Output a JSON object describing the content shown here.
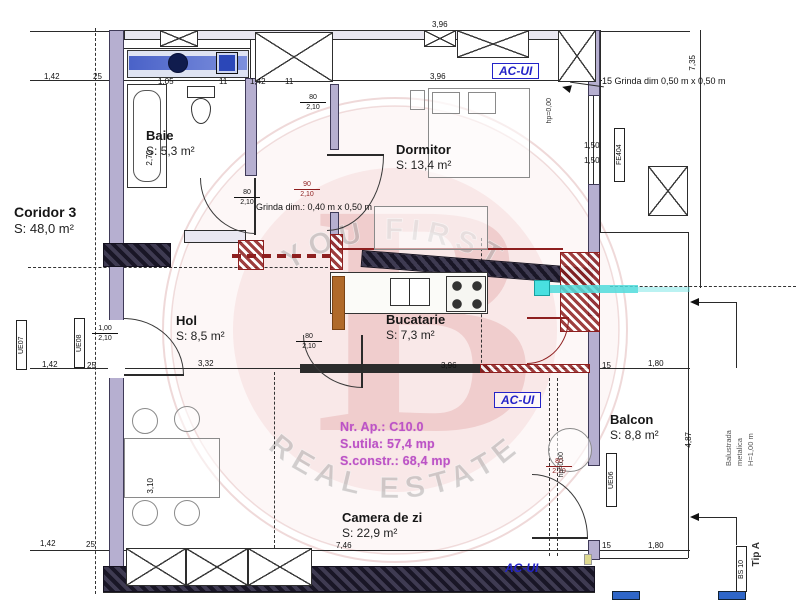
{
  "plan": {
    "rooms": [
      {
        "label": "Coridor 3",
        "area": "S: 48,0 m²",
        "x": 14,
        "y": 204,
        "fs": 14
      },
      {
        "label": "Baie",
        "area": "S: 5,3 m²",
        "x": 146,
        "y": 128,
        "fs": 13
      },
      {
        "label": "Dormitor",
        "area": "S: 13,4 m²",
        "x": 396,
        "y": 142,
        "fs": 13
      },
      {
        "label": "Hol",
        "area": "S: 8,5 m²",
        "x": 176,
        "y": 313,
        "fs": 13
      },
      {
        "label": "Bucatarie",
        "area": "S: 7,3 m²",
        "x": 386,
        "y": 312,
        "fs": 13
      },
      {
        "label": "Balcon",
        "area": "S: 8,8 m²",
        "x": 610,
        "y": 412,
        "fs": 13
      },
      {
        "label": "Camera de zi",
        "area": "S: 22,9 m²",
        "x": 342,
        "y": 510,
        "fs": 13
      }
    ],
    "apartment_info": {
      "line1": "Nr. Ap.: C10.0",
      "line2": "S.utila: 57,4 mp",
      "line3": "S.constr.: 68,4 mp"
    },
    "notes": [
      {
        "text": "15 Grinda dim 0,50 m x 0,50 m",
        "x": 602,
        "y": 76
      },
      {
        "text": "Grinda dim.: 0,40 m x 0,50 m",
        "x": 256,
        "y": 202
      }
    ],
    "ac_labels": [
      {
        "text": "AC-UI",
        "x": 492,
        "y": 63,
        "boxed": true
      },
      {
        "text": "AC-UI",
        "x": 494,
        "y": 392,
        "boxed": true
      },
      {
        "text": "AC-UI",
        "x": 505,
        "y": 561,
        "boxed": false
      }
    ],
    "dimensions": [
      {
        "t": "3,96",
        "x": 432,
        "y": 20
      },
      {
        "t": "1,42",
        "x": 44,
        "y": 72
      },
      {
        "t": "25",
        "x": 93,
        "y": 72
      },
      {
        "t": "1,05",
        "x": 158,
        "y": 77
      },
      {
        "t": "11",
        "x": 219,
        "y": 77
      },
      {
        "t": "1,42",
        "x": 250,
        "y": 77
      },
      {
        "t": "11",
        "x": 285,
        "y": 77
      },
      {
        "t": "3,96",
        "x": 430,
        "y": 72
      },
      {
        "t": "7,35",
        "x": 688,
        "y": 55,
        "v": true
      },
      {
        "t": "2,72",
        "x": 145,
        "y": 150,
        "v": true
      },
      {
        "t": "1,50",
        "x": 584,
        "y": 141
      },
      {
        "t": "1,50",
        "x": 584,
        "y": 156
      },
      {
        "t": "1,42",
        "x": 42,
        "y": 360
      },
      {
        "t": "25",
        "x": 87,
        "y": 361
      },
      {
        "t": "3,32",
        "x": 198,
        "y": 359
      },
      {
        "t": "3,96",
        "x": 441,
        "y": 361
      },
      {
        "t": "15",
        "x": 602,
        "y": 361
      },
      {
        "t": "1,80",
        "x": 648,
        "y": 359
      },
      {
        "t": "4,87",
        "x": 684,
        "y": 432,
        "v": true
      },
      {
        "t": "3,10",
        "x": 146,
        "y": 478,
        "v": true
      },
      {
        "t": "1,42",
        "x": 40,
        "y": 539
      },
      {
        "t": "25",
        "x": 86,
        "y": 540
      },
      {
        "t": "7,46",
        "x": 336,
        "y": 541
      },
      {
        "t": "15",
        "x": 602,
        "y": 541
      },
      {
        "t": "1,80",
        "x": 648,
        "y": 541
      }
    ],
    "door_labels": [
      {
        "w": "80",
        "h": "2,10",
        "x": 300,
        "y": 94,
        "red": false
      },
      {
        "w": "80",
        "h": "2,10",
        "x": 234,
        "y": 189,
        "red": false
      },
      {
        "w": "90",
        "h": "2,10",
        "x": 294,
        "y": 181,
        "red": true
      },
      {
        "w": "1,00",
        "h": "2,10",
        "x": 92,
        "y": 325,
        "red": false
      },
      {
        "w": "80",
        "h": "2,10",
        "x": 296,
        "y": 333,
        "red": false
      },
      {
        "w": "80",
        "h": "2,10",
        "x": 546,
        "y": 458,
        "red": true
      }
    ],
    "window_labels": [
      {
        "text": "FE404",
        "x": 614,
        "y": 128,
        "h": 54
      },
      {
        "text": "UE06",
        "x": 606,
        "y": 453,
        "h": 54
      },
      {
        "text": "UE07",
        "x": 16,
        "y": 320,
        "h": 50
      },
      {
        "text": "UE08",
        "x": 74,
        "y": 318,
        "h": 50
      },
      {
        "text": "BS 10",
        "x": 736,
        "y": 546,
        "h": 46
      }
    ],
    "vertical_texts": [
      {
        "text": "hp=0,00",
        "x": 546,
        "y": 98,
        "fs": 7
      },
      {
        "text": "hp=0,00",
        "x": 558,
        "y": 452,
        "fs": 7
      },
      {
        "text": "Tip A",
        "x": 751,
        "y": 542,
        "fs": 10,
        "bold": true
      }
    ],
    "balustrade": {
      "l1": "Balustrada",
      "l2": "metalica",
      "l3": "H=1,00 m"
    },
    "watermark": {
      "top": "YOU FIRST",
      "bottom": "REAL ESTATE",
      "letter": "B"
    },
    "colors": {
      "wall": "#b6afd0",
      "red": "#8e1f1f",
      "blue": "#2323c8",
      "magenta": "#bc53c6",
      "cyan": "#45d9d9"
    }
  }
}
